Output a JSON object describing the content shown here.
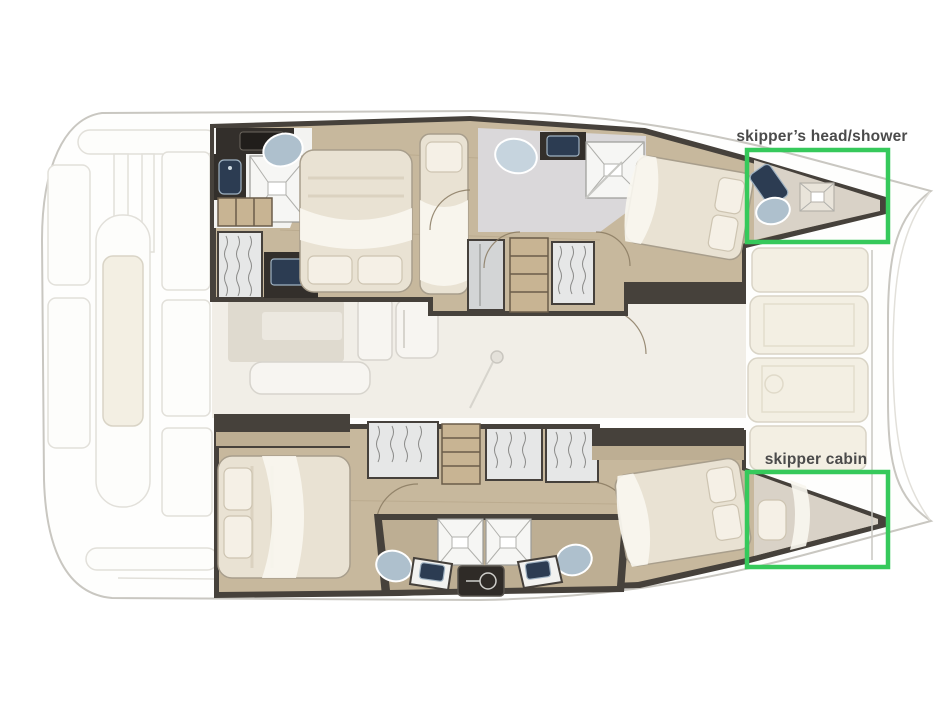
{
  "annotations": {
    "accent_color": "#36c95b",
    "label_color": "#4b4b4b",
    "head_shower": {
      "label": "skipper’s head/shower"
    },
    "skipper_cabin": {
      "label": "skipper cabin"
    }
  },
  "palette": {
    "hull_wall": "#46413b",
    "wood_floor": "#c7b89d",
    "bed_linen": "#e9e2d3",
    "fixture_blue": "#aec0cd",
    "sink_navy": "#2c3c52",
    "salon_floor": "#f1eee7",
    "foredeck_pad": "#f3efe3"
  }
}
